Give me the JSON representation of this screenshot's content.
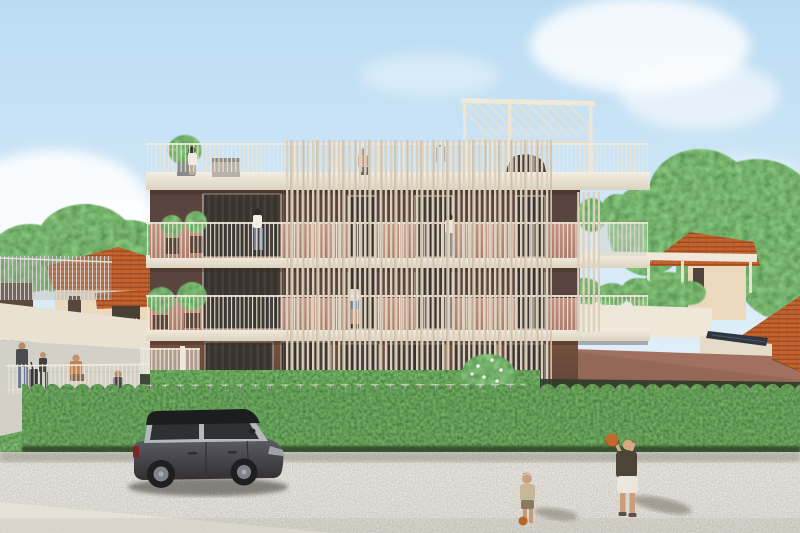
{
  "scene": {
    "type": "architectural-exterior-rendering",
    "setting": "Modern three-story apartment building with rooftop pergola seen from a gravel street",
    "time_of_day": "daytime, clear sky with soft clouds",
    "description": "Cream concrete balcony slabs wrap a facade of dark maroon and salmon panels with floor-to-ceiling windows; a tall vertical timber-slat screen covers the center; residents stand on balconies and the roof terrace; a planted annex wing with solar panels sits at right; a dense trimmed hedge separates the garden from a gravel road where a dark hatchback is parked and two children play with a basketball; neighboring terracotta-roofed houses, fences and large trees fill the background."
  },
  "palette": {
    "sky_top": "#badcf3",
    "sky_bottom": "#ecf5fb",
    "cloud": "#ffffff",
    "slab_cream": "#efe8d9",
    "slat_cream": "#dcd1bf",
    "railing_cream": "#eee6d8",
    "facade_maroon": "#5b443d",
    "facade_salmon": "#bd8b78",
    "ground_brown": "#6e4a3f",
    "annex_rose": "#a1705f",
    "window_dark": "#393431",
    "hedge_green": "#445c33",
    "tree_green": "#6d9153",
    "grass_green": "#5d7c43",
    "roof_terracotta": "#c4622e",
    "house_cream": "#ead9bd",
    "road_gravel": "#dad6cf",
    "car_body": "#46464b",
    "car_roof": "#1c1d1f",
    "basketball_orange": "#c06a2c",
    "solar_panel": "#2e3640",
    "skin": "#c79475"
  },
  "building": {
    "floors_above_ground": 3,
    "features": [
      "roof terrace with cream baluster railing",
      "white pergola with louvered roof on the right of the roof terrace",
      "full-width continuous balconies on every floor",
      "tall vertical slat privacy screen over the center bays",
      "floor-to-ceiling dark glazed windows",
      "potted plants and shrubs on balconies",
      "glass panel balustrade on the upper-right balcony",
      "right annex wing with roof garden, white planter parapet and solar panels",
      "white entrance gate and thin metal garden fence"
    ],
    "occupants": [
      {
        "id": "roof-terrace-woman",
        "where": "roof terrace left",
        "look": "white top, dark hair, beside potted tree"
      },
      {
        "id": "roof-terrace-man",
        "where": "roof terrace center",
        "look": "shirtless, standing at railing"
      },
      {
        "id": "floor2-left-woman",
        "where": "2nd floor left balcony",
        "look": "white top and jeans"
      },
      {
        "id": "floor2-right-woman",
        "where": "2nd floor right bay behind slat screen",
        "look": "white top"
      },
      {
        "id": "floor1-center-woman",
        "where": "1st floor center balcony",
        "look": "light top, blue shorts"
      }
    ]
  },
  "street": {
    "surface": "light speckled gravel with pale sidewalk strip at lower left",
    "vehicle": {
      "type": "5-door hatchback",
      "color": "dark graphite with black roof and silver window band",
      "facing": "right"
    },
    "children": [
      {
        "id": "boy-with-basketball",
        "clothing": "dark olive t-shirt, white shorts",
        "action": "raising an orange basketball overhead"
      },
      {
        "id": "toddler",
        "clothing": "beige outfit",
        "action": "walking toward the hedge carrying a small ball"
      }
    ]
  },
  "left_background": {
    "houses": "cream house with terracotta gable roof and covered porch, dark outbuilding at far left",
    "infrastructure": "retaining wall, sloped concrete walkway, slatted fences, low white fence, shrub rows",
    "pedestrians": [
      {
        "id": "man-with-luggage",
        "look": "dark top, jeans, pulling a dark suitcase"
      },
      {
        "id": "walking-child",
        "look": "dark clothes"
      },
      {
        "id": "seated-person",
        "look": "warm tan top, sitting on walkway edge"
      },
      {
        "id": "lower-walker",
        "look": "dark clothes, walking along fence"
      }
    ]
  },
  "right_background": {
    "houses": "cream house with terracotta hip roof and small dark window; large foreground terracotta roof at far right",
    "vegetation": "large leafy green trees overhanging the annex"
  },
  "foreground": {
    "hedge": "dense trimmed hedge running the full width between garden and road",
    "garden": "inner hedge rows, white flowering bush at the building base, thin metal fence embedded in greenery"
  },
  "counts": {
    "visible_people": 11,
    "vehicles": 1,
    "basketballs": 2
  }
}
